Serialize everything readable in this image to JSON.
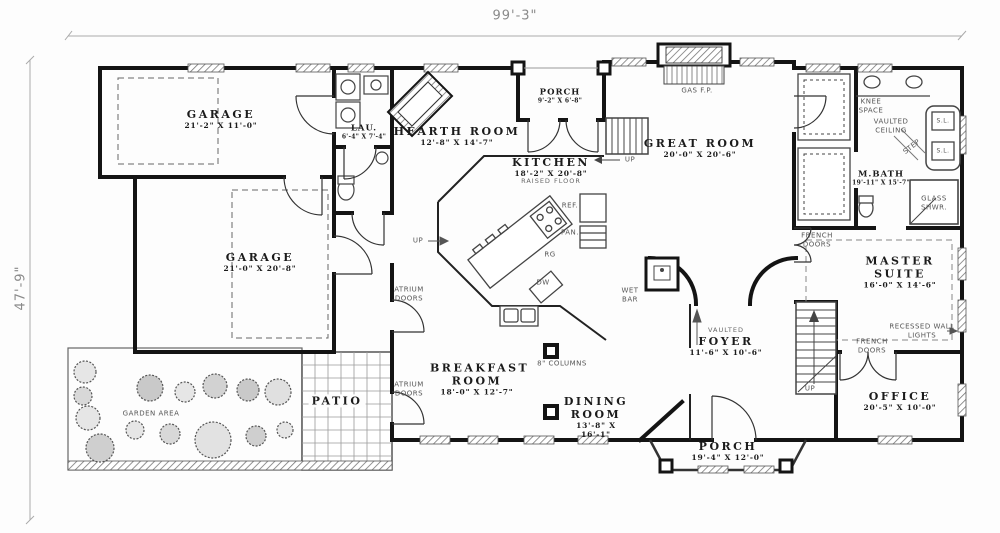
{
  "drawing": {
    "type": "house floor plan",
    "overall_width": "99'-3\"",
    "overall_depth": "47'-9\""
  },
  "rooms": [
    {
      "id": "garage-1",
      "name": "GARAGE",
      "dims": "21'-2\" X 11'-0\""
    },
    {
      "id": "garage-2",
      "name": "GARAGE",
      "dims": "21'-0\" X 20'-8\""
    },
    {
      "id": "laundry",
      "name": "LAU.",
      "dims": "6'-4\" X 7'-4\""
    },
    {
      "id": "hearth-room",
      "name": "HEARTH ROOM",
      "dims": "12'-8\" X 14'-7\""
    },
    {
      "id": "porch-top",
      "name": "PORCH",
      "dims": "9'-2\" X 6'-8\""
    },
    {
      "id": "kitchen",
      "name": "KITCHEN",
      "dims": "18'-2\" X 20'-8\"",
      "note": "RAISED FLOOR"
    },
    {
      "id": "great-room",
      "name": "GREAT ROOM",
      "dims": "20'-0\" X 20'-6\""
    },
    {
      "id": "master-bath",
      "name": "M.BATH",
      "dims": "19'-11\" X 15'-7\""
    },
    {
      "id": "master-suite",
      "name": "MASTER SUITE",
      "dims": "16'-0\" X 14'-6\""
    },
    {
      "id": "office",
      "name": "OFFICE",
      "dims": "20'-5\" X 10'-0\""
    },
    {
      "id": "foyer",
      "name": "FOYER",
      "dims": "11'-6\" X 10'-6\"",
      "note": "VAULTED"
    },
    {
      "id": "breakfast-room",
      "name": "BREAKFAST ROOM",
      "dims": "18'-0\" X 12'-7\""
    },
    {
      "id": "dining-room",
      "name": "DINING ROOM",
      "dims": "13'-8\" X 16'-1\""
    },
    {
      "id": "porch-bottom",
      "name": "PORCH",
      "dims": "19'-4\" X 12'-0\""
    },
    {
      "id": "patio",
      "name": "PATIO"
    },
    {
      "id": "garden",
      "name": "GARDEN AREA"
    }
  ],
  "annotations": {
    "gas_fp": "GAS F.P.",
    "knee_space": "KNEE SPACE",
    "vaulted_ceiling": "VAULTED CEILING",
    "step": "STEP",
    "sl": "S.L.",
    "glass_shwr": "GLASS SHWR.",
    "french_doors": "FRENCH DOORS",
    "recessed_wall_lights": "RECESSED WALL LIGHTS",
    "wet_bar": "WET BAR",
    "up": "UP",
    "ref": "REF.",
    "pan": "PAN.",
    "rg": "RG",
    "dw": "DW",
    "columns": "8\" COLUMNS",
    "atrium_doors": "ATRIUM DOORS"
  }
}
